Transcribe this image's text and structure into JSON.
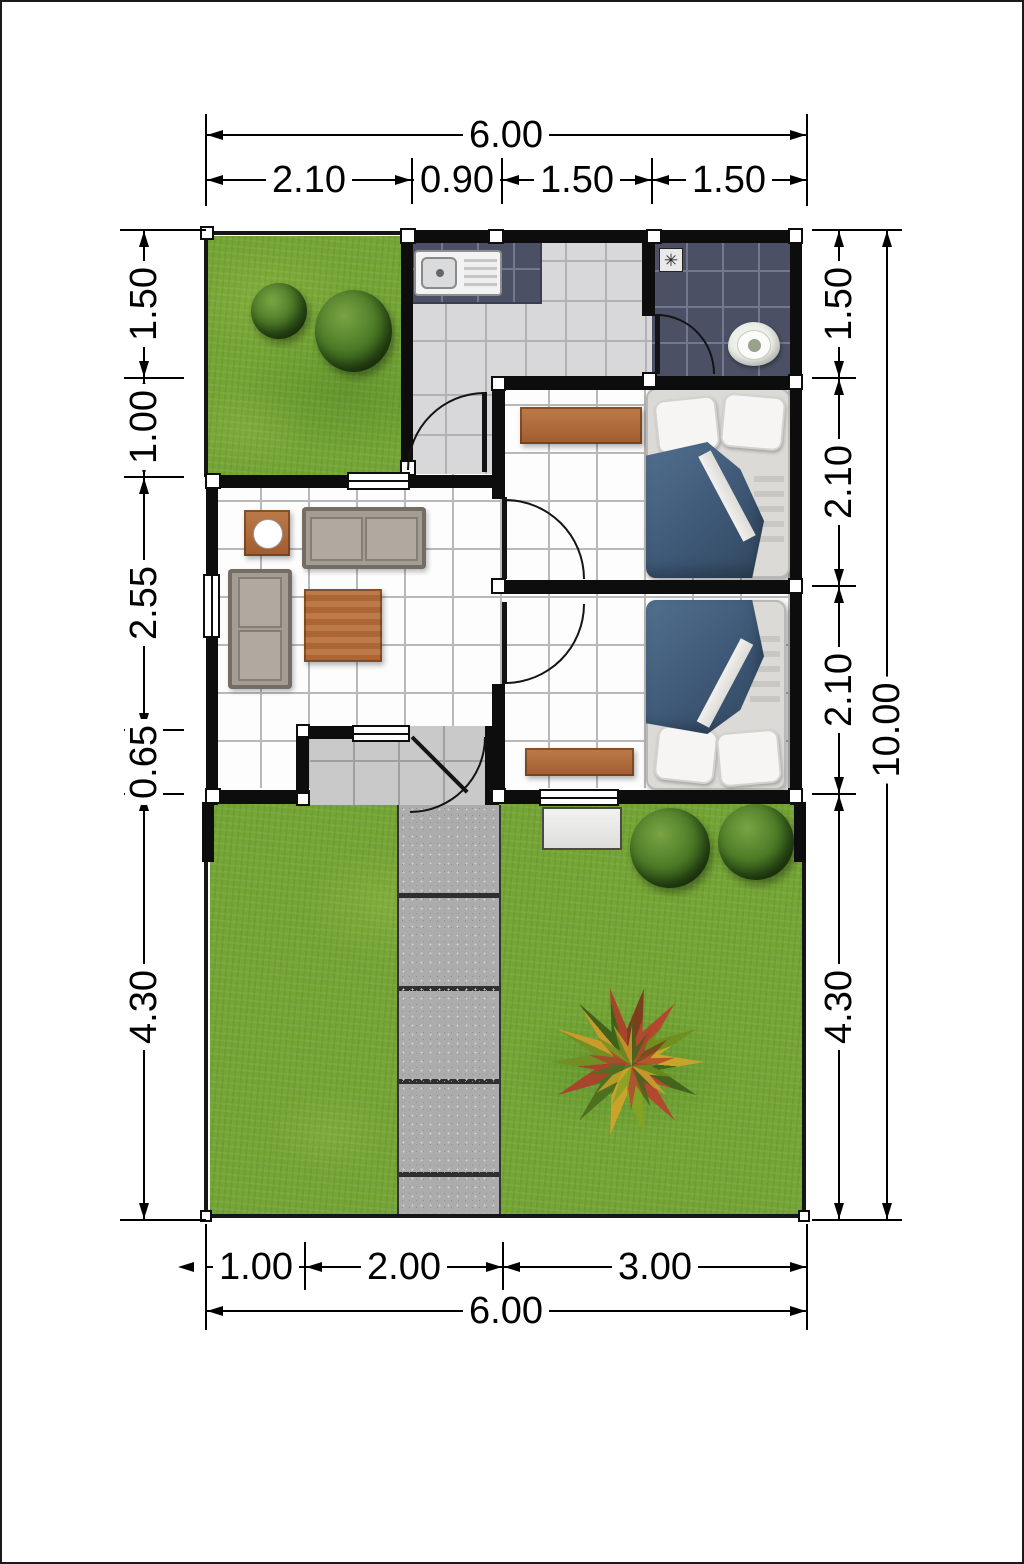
{
  "dims": {
    "top": {
      "total": "6.00",
      "segments": [
        "2.10",
        "0.90",
        "1.50",
        "1.50"
      ]
    },
    "left": {
      "segments": [
        "1.50",
        "1.00",
        "2.55",
        "0.65",
        "4.30"
      ]
    },
    "right": {
      "segments": [
        "1.50",
        "2.10",
        "2.10",
        "4.30"
      ],
      "total": "10.00"
    },
    "bottom": {
      "segments": [
        "1.00",
        "2.00",
        "3.00"
      ],
      "total": "6.00"
    }
  },
  "icons": {
    "floor_drain": "✳"
  },
  "colors": {
    "wall": "#0d0d0d",
    "grass_green": "#74a535",
    "tile_dark_navy": "#4b5064",
    "tile_light_gray": "#d8d8da",
    "room_tile_white": "#fdfdfd",
    "wood_brown": "#b06a3e",
    "duvet_blue": "#3c5674",
    "walkway_gray": "#acacac"
  }
}
